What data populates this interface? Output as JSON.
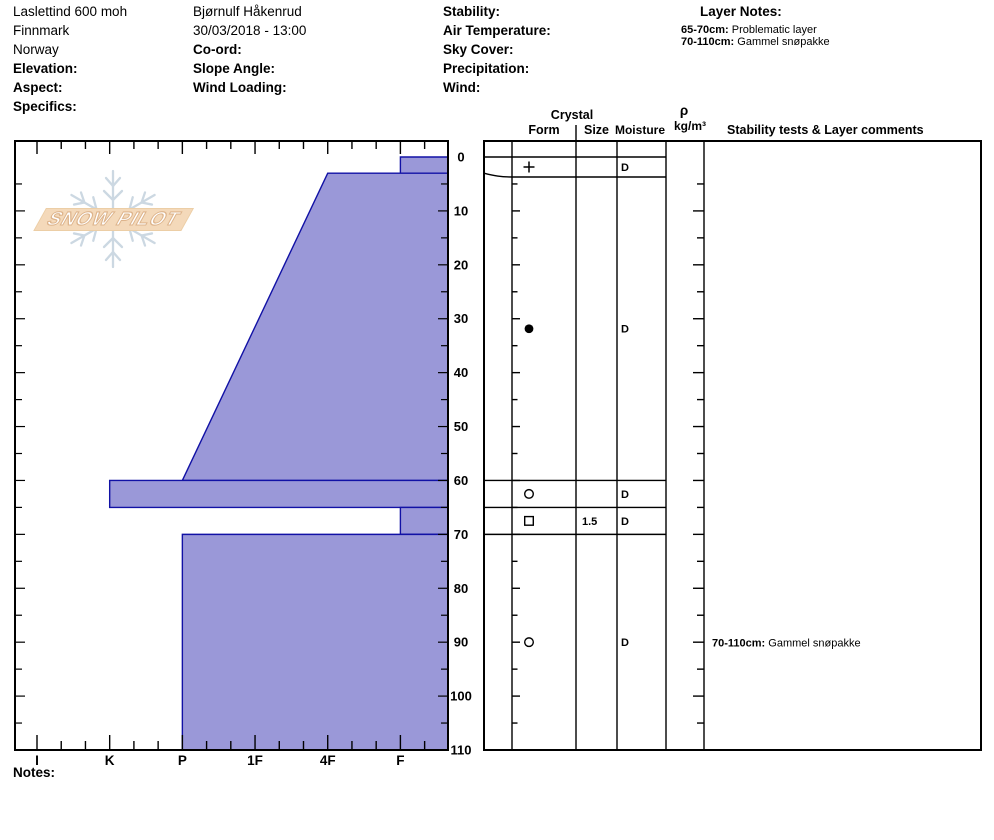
{
  "header": {
    "col1": {
      "line1": "Laslettind 600 moh",
      "line2": "Finnmark",
      "line3": "Norway",
      "label1": "Elevation:",
      "label2": "Aspect:",
      "label3": "Specifics:"
    },
    "col2": {
      "line1": "Bjørnulf Håkenrud",
      "line2": "30/03/2018 - 13:00",
      "label1": "Co-ord:",
      "label2": "Slope Angle:",
      "label3": "Wind Loading:"
    },
    "col3": {
      "label1": "Stability:",
      "label2": "Air Temperature:",
      "label3": "Sky Cover:",
      "label4": "Precipitation:",
      "label5": "Wind:"
    },
    "layer_notes": {
      "title": "Layer Notes:",
      "notes": [
        {
          "range": "65-70cm:",
          "text": "Problematic layer"
        },
        {
          "range": "70-110cm:",
          "text": "Gammel snøpakke"
        }
      ]
    }
  },
  "table_headers": {
    "crystal": "Crystal",
    "form": "Form",
    "size": "Size",
    "moisture": "Moisture",
    "rho": "ρ",
    "rho_units": "kg/m³",
    "stability": "Stability tests & Layer comments"
  },
  "notes_label": "Notes:",
  "logo": {
    "text": "SNOW PILOT",
    "banner_color": "#f4d9ba",
    "flake_color": "#ccd8e2"
  },
  "chart_data": {
    "type": "bar",
    "title": "Snow pit profile: layer hardness vs depth",
    "depth_axis": {
      "unit": "cm",
      "range": [
        0,
        110
      ],
      "major_tick": 10,
      "minor_tick": 5,
      "labels": [
        0,
        10,
        20,
        30,
        40,
        50,
        60,
        70,
        80,
        90,
        100,
        110
      ]
    },
    "hardness_axis": {
      "categories": [
        "I",
        "K",
        "P",
        "1F",
        "4F",
        "F"
      ],
      "minor_divisions_per_step": 3,
      "note": "hand hardness, hardest (I=ice) at left, softest (F=fist) at right"
    },
    "colors": {
      "layer_fill": "#9a98d8",
      "layer_border": "#1111a5"
    },
    "layers": [
      {
        "top_cm": 0,
        "bottom_cm": 3,
        "hardness_top": "F",
        "hardness_bottom": "F",
        "grain_form": "+",
        "grain_size_mm": "",
        "moisture": "D",
        "density": "",
        "comment_range": "",
        "comment": ""
      },
      {
        "top_cm": 3,
        "bottom_cm": 60,
        "hardness_top": "4F",
        "hardness_bottom": "P",
        "grain_form": "●",
        "grain_size_mm": "",
        "moisture": "D",
        "density": "",
        "comment_range": "",
        "comment": ""
      },
      {
        "top_cm": 60,
        "bottom_cm": 65,
        "hardness_top": "K",
        "hardness_bottom": "K",
        "grain_form": "○",
        "grain_size_mm": "",
        "moisture": "D",
        "density": "",
        "comment_range": "",
        "comment": ""
      },
      {
        "top_cm": 65,
        "bottom_cm": 70,
        "hardness_top": "F",
        "hardness_bottom": "F",
        "grain_form": "□",
        "grain_size_mm": "1.5",
        "moisture": "D",
        "density": "",
        "comment_range": "",
        "comment": ""
      },
      {
        "top_cm": 70,
        "bottom_cm": 110,
        "hardness_top": "P",
        "hardness_bottom": "P",
        "grain_form": "○",
        "grain_size_mm": "",
        "moisture": "D",
        "density": "",
        "comment_range": "70-110cm:",
        "comment": "Gammel snøpakke"
      }
    ]
  }
}
